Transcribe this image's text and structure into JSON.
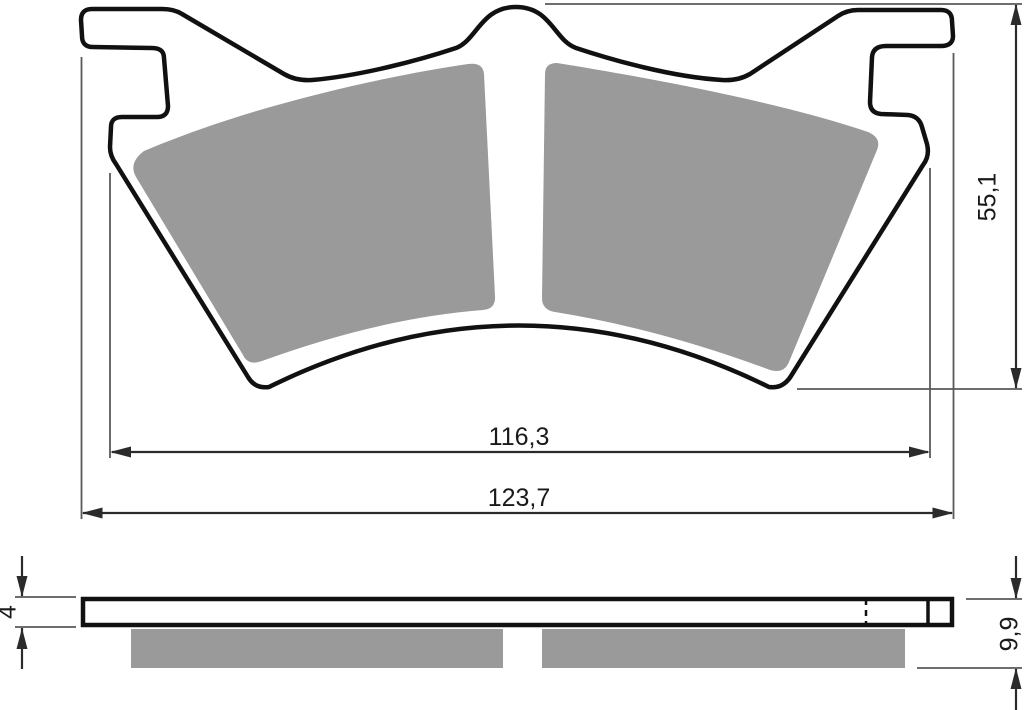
{
  "drawing": {
    "type": "technical-drawing",
    "subject": "disc-brake-pad",
    "views": [
      "top-view",
      "side-view"
    ],
    "dimensions": {
      "top_view": {
        "pad_span_width": "116,3",
        "overall_width": "123,7",
        "overall_height": "55,1"
      },
      "side_view": {
        "backplate_thickness": "4",
        "overall_thickness": "9,9"
      }
    },
    "colors": {
      "friction_material": "#9a9a9a",
      "outline": "#111111",
      "dimension_line": "#2b2b2b",
      "extension_line": "#5a5a5a",
      "background": "#ffffff"
    }
  }
}
